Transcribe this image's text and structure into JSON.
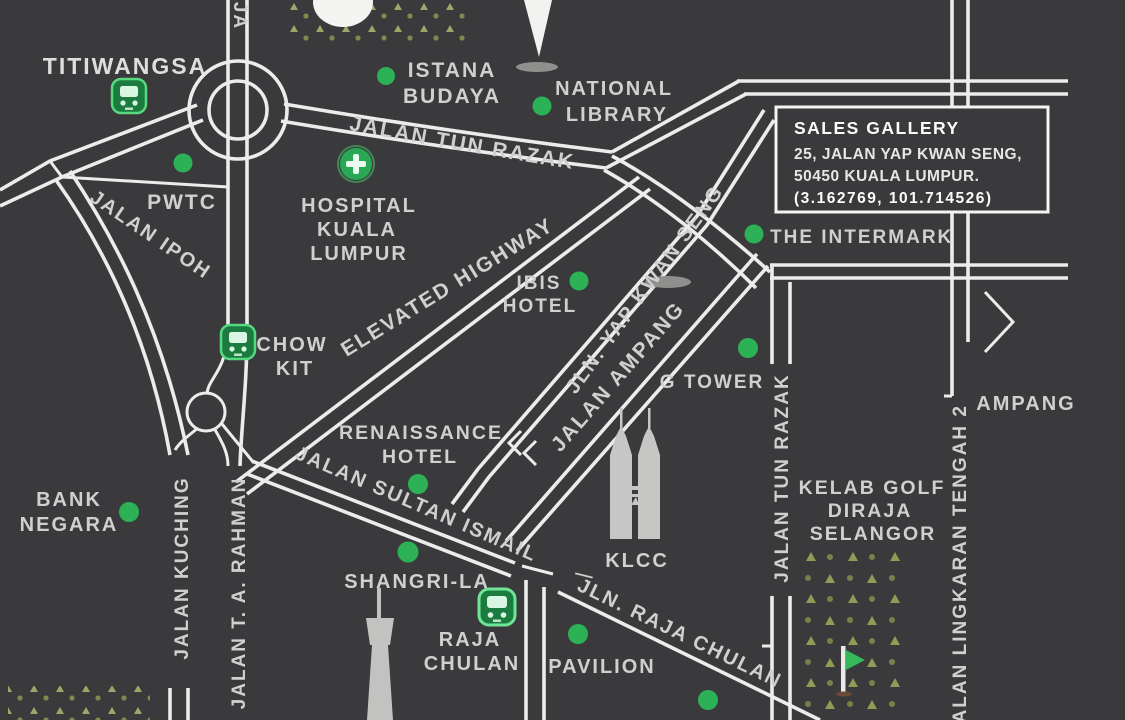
{
  "map": {
    "title": "Sales gallery location map - Kuala Lumpur",
    "colors": {
      "background": "#3a393b",
      "road": "#ececea",
      "label": "#d0d0ce",
      "poi_green": "#2db157",
      "station_green": "#57d981",
      "park_olive": "#8e9c55",
      "icon_gray": "#c6c6c4"
    },
    "sales_gallery": {
      "title": "SALES GALLERY",
      "address_line1": "25, JALAN YAP KWAN SENG,",
      "address_line2": "50450 KUALA LUMPUR.",
      "coordinates": "(3.162769, 101.714526)"
    },
    "roads": {
      "jalan_tun_razak": "JALAN TUN RAZAK",
      "jalan_ipoh": "JALAN IPOH",
      "elevated_highway": "ELEVATED HIGHWAY",
      "jln_yap_kwan_seng": "JLN. YAP KWAN SENG",
      "jalan_ampang": "JALAN AMPANG",
      "jalan_kuching": "JALAN KUCHING",
      "jalan_ta_rahman": "JALAN T. A. RAHMAN",
      "jalan_sultan_ismail": "JALAN SULTAN ISMAIL",
      "jln_raja_chulan": "JLN. RAJA CHULAN",
      "jalan_lingkaran_tengah_2": "JALAN LINGKARAN TENGAH 2",
      "ampang_direction": "AMPANG",
      "top_edge_fragment": "JA",
      "separator_dash": "—"
    },
    "places": {
      "titiwangsa": "TITIWANGSA",
      "istana_budaya": {
        "lines": [
          "ISTANA",
          "BUDAYA"
        ]
      },
      "national_library": {
        "lines": [
          "NATIONAL",
          "LIBRARY"
        ]
      },
      "pwtc": "PWTC",
      "hospital_kl": {
        "lines": [
          "HOSPITAL",
          "KUALA",
          "LUMPUR"
        ]
      },
      "ibis_hotel": {
        "lines": [
          "IBIS",
          "HOTEL"
        ]
      },
      "the_intermark": "THE INTERMARK",
      "chow_kit": {
        "lines": [
          "CHOW",
          "KIT"
        ]
      },
      "g_tower": "G TOWER",
      "renaissance_hotel": {
        "lines": [
          "RENAISSANCE",
          "HOTEL"
        ]
      },
      "klcc": "KLCC",
      "bank_negara": {
        "lines": [
          "BANK",
          "NEGARA"
        ]
      },
      "kelab_golf": {
        "lines": [
          "KELAB GOLF",
          "DIRAJA",
          "SELANGOR"
        ]
      },
      "shangri_la": "SHANGRI-LA",
      "raja_chulan": {
        "lines": [
          "RAJA",
          "CHULAN"
        ]
      },
      "pavilion": "PAVILION"
    }
  }
}
